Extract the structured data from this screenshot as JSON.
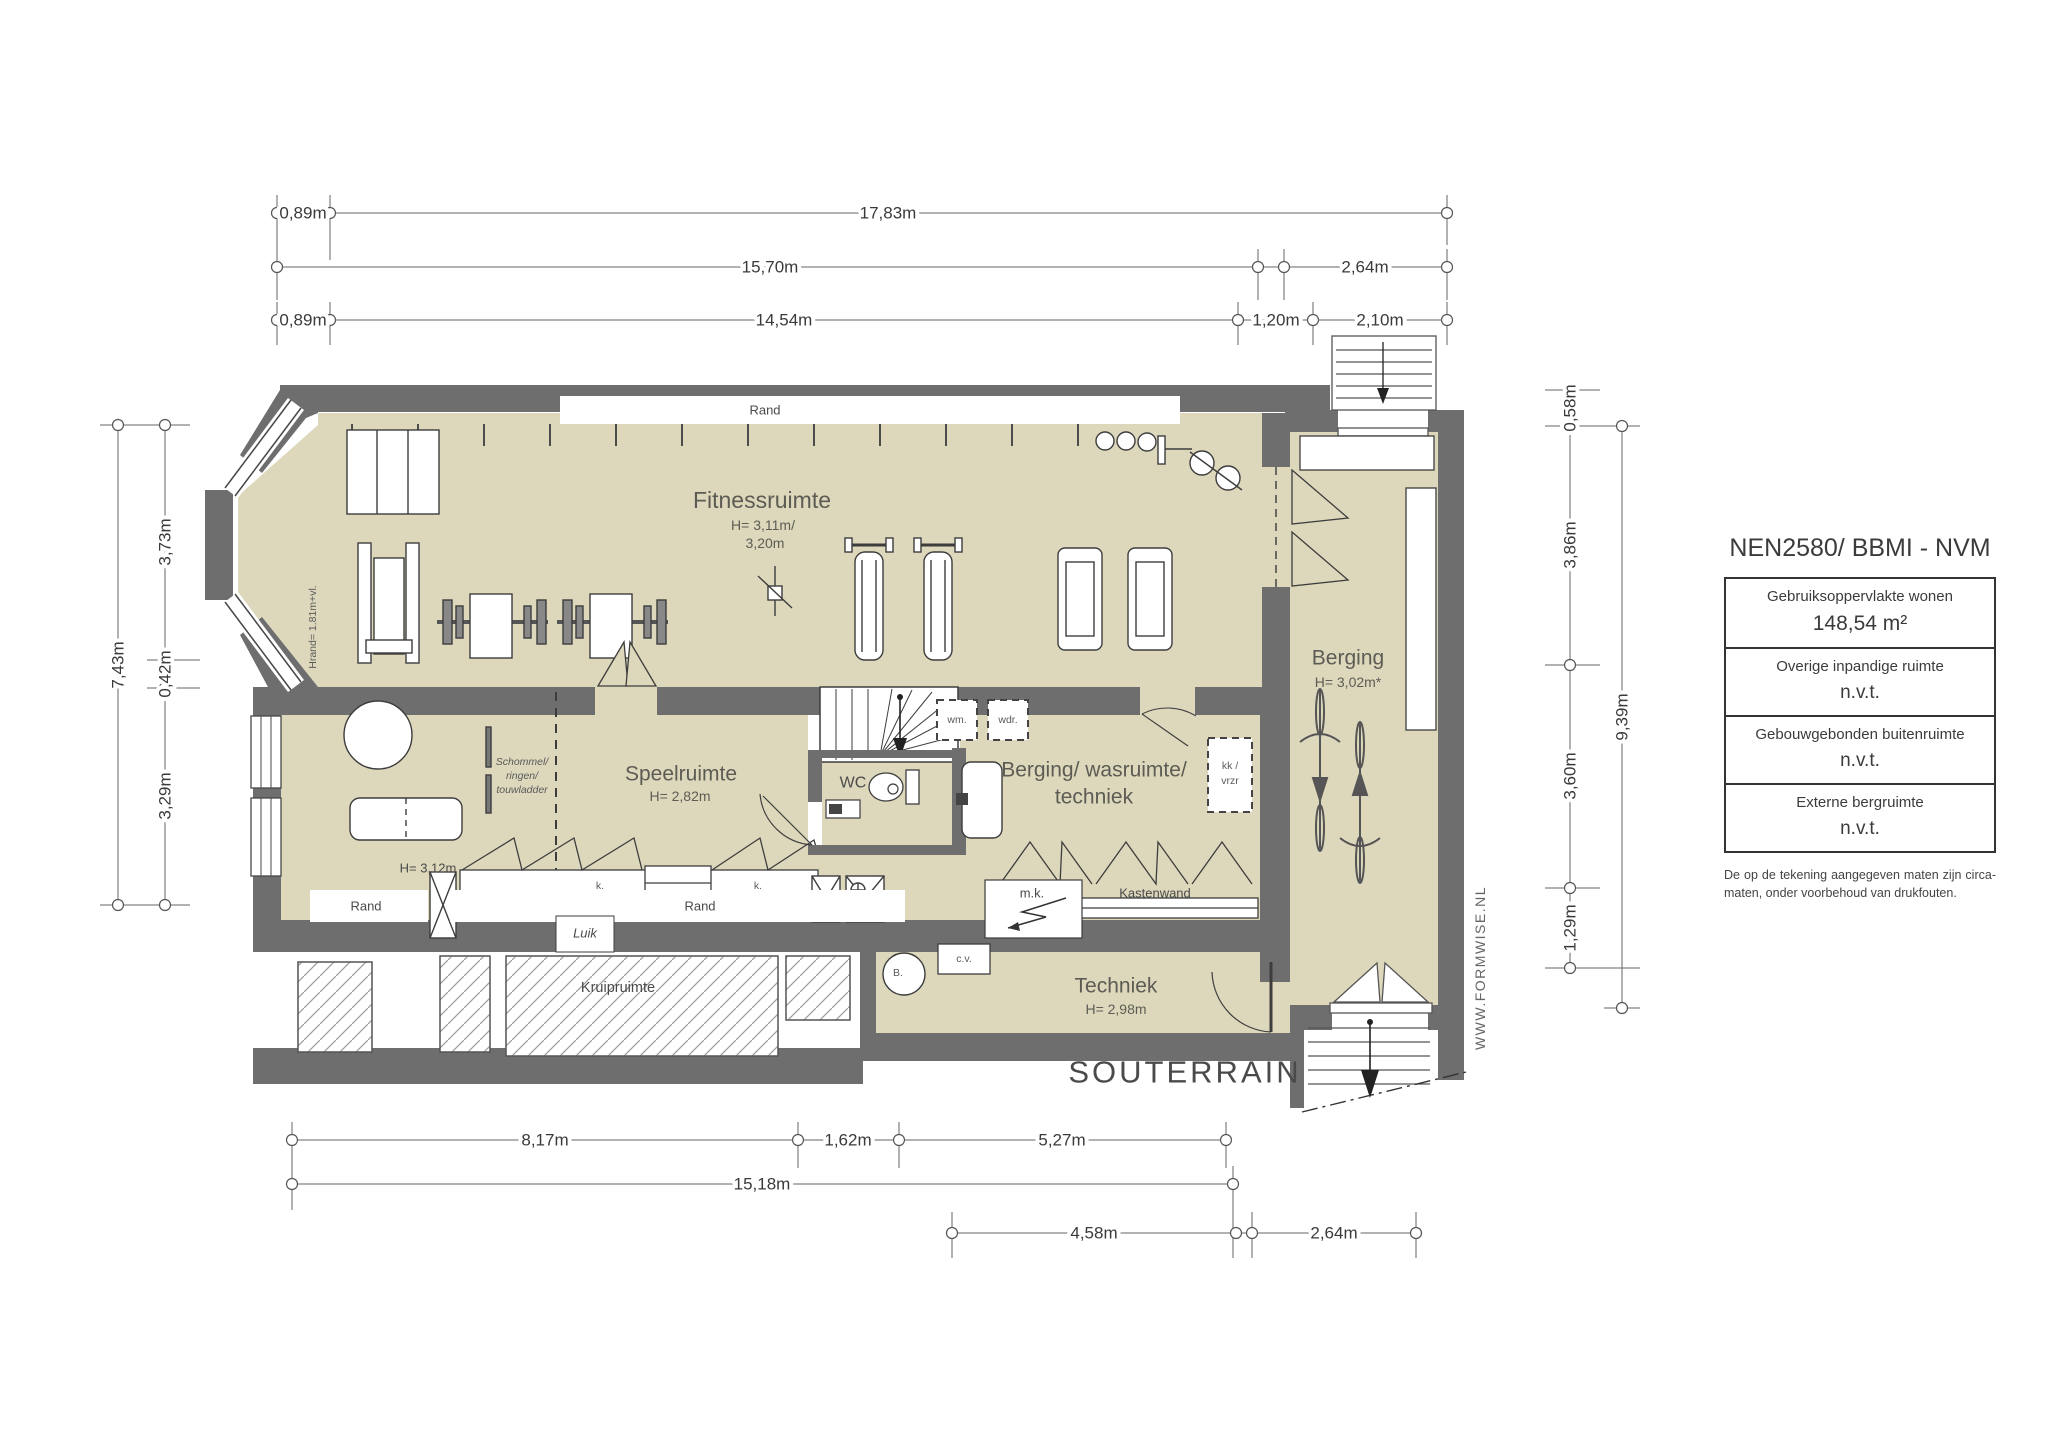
{
  "colors": {
    "wall": "#6e6e6e",
    "floor": "#ddd8bc"
  },
  "plan": {
    "title": "SOUTERRAIN",
    "watermark": "WWW.FORMWISE.NL",
    "rooms": {
      "fitness": {
        "name": "Fitnessruimte",
        "h1": "H= 3,11m/",
        "h2": "3,20m"
      },
      "speel": {
        "name": "Speelruimte",
        "h": "H= 2,82m",
        "h_left": "H= 3,12m"
      },
      "wc": {
        "name": "WC"
      },
      "was": {
        "l1": "Berging/ wasruimte/",
        "l2": "techniek"
      },
      "berging": {
        "name": "Berging",
        "h": "H= 3,02m*"
      },
      "techniek": {
        "name": "Techniek",
        "h": "H= 2,98m"
      },
      "kruip": {
        "name": "Kruipruimte"
      }
    },
    "labels": {
      "rand": "Rand",
      "luik": "Luik",
      "k": "k.",
      "mk": "m.k.",
      "kastenwand": "Kastenwand",
      "wm": "wm.",
      "wdr": "wdr.",
      "kk": "kk /",
      "vrzr": "vrzr",
      "schommel1": "Schommel/",
      "schommel2": "ringen/",
      "schommel3": "touwladder",
      "cv": "c.v.",
      "b": "B.",
      "hrand": "Hrand= 1.81m+vl."
    }
  },
  "dims": {
    "t1a": "0,89m",
    "t1b": "17,83m",
    "t2a": "15,70m",
    "t2b": "2,64m",
    "t3a": "0,89m",
    "t3b": "14,54m",
    "t3c": "1,20m",
    "t3d": "2,10m",
    "l1": "7,43m",
    "l2a": "3,73m",
    "l2b": "0,42m",
    "l2c": "3,29m",
    "r1a": "0,58m",
    "r1b": "3,86m",
    "r1c": "3,60m",
    "r1d": "1,29m",
    "r2": "9,39m",
    "b1a": "8,17m",
    "b1b": "1,62m",
    "b1c": "5,27m",
    "b2": "15,18m",
    "b3a": "4,58m",
    "b3b": "2,64m"
  },
  "legend": {
    "title": "NEN2580/ BBMI - NVM",
    "rows": [
      {
        "label": "Gebruiksoppervlakte wonen",
        "value": "148,54 m²"
      },
      {
        "label": "Overige inpandige ruimte",
        "value": "n.v.t."
      },
      {
        "label": "Gebouwgebonden buitenruimte",
        "value": "n.v.t."
      },
      {
        "label": "Externe bergruimte",
        "value": "n.v.t."
      }
    ],
    "note": "De op de tekening aangegeven maten zijn circa-maten, onder voorbehoud van drukfouten."
  }
}
